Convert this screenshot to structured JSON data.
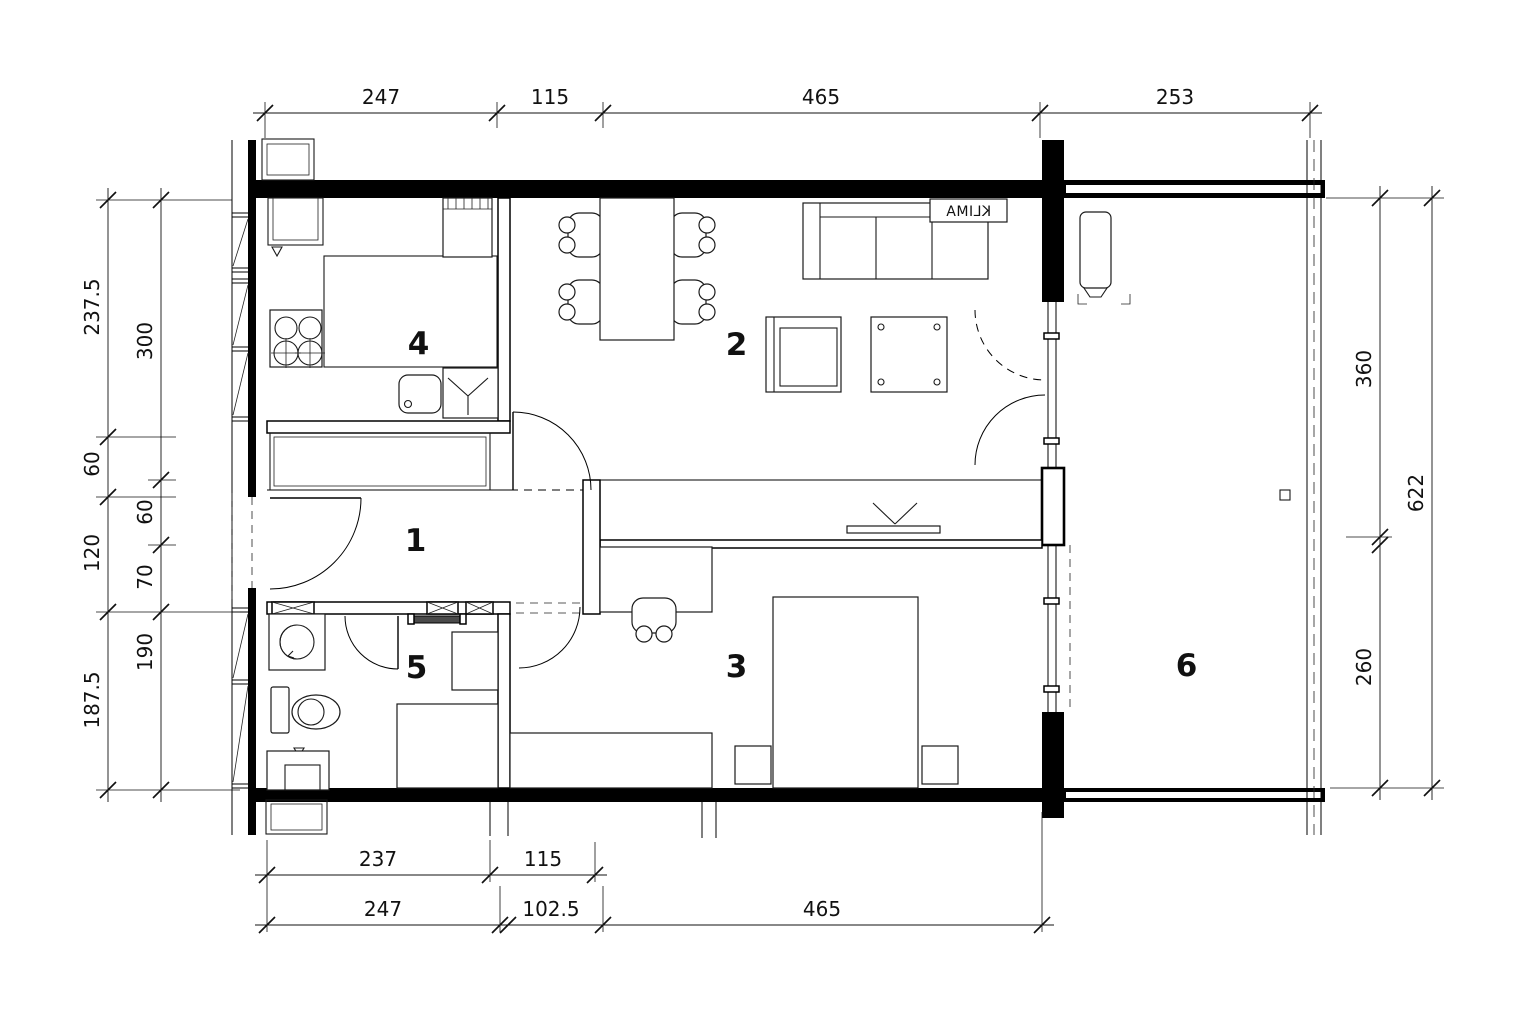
{
  "plan": {
    "room_numbers": {
      "hall": "1",
      "living": "2",
      "bedroom": "3",
      "kitchen": "4",
      "bathroom": "5",
      "balcony": "6"
    },
    "klima_label": "KLIMA",
    "dims": {
      "top": [
        "247",
        "115",
        "465",
        "253"
      ],
      "bottom_inner": [
        "237",
        "115"
      ],
      "bottom_outer": [
        "247",
        "102.5",
        "465"
      ],
      "left_outer": [
        "237.5",
        "60",
        "120",
        "187.5"
      ],
      "left_inner": [
        "300",
        "60",
        "70",
        "190"
      ],
      "right_inner": [
        "360",
        "260"
      ],
      "right_outer": [
        "622"
      ]
    }
  }
}
